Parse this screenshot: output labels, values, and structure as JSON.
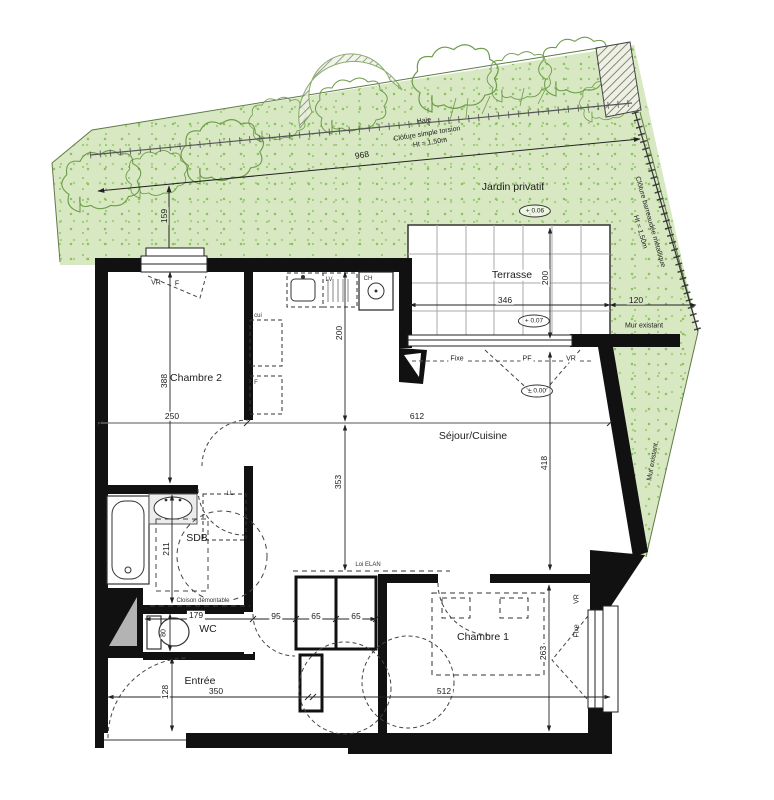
{
  "garden": {
    "label": "Jardin privatif",
    "level": "+ 0.06",
    "hedge": "Haie",
    "fence_top_type": "Clôture simple torsion",
    "fence_top_height": "Ht = 1,50m",
    "fence_right_type": "Clôture barreaudée métallique",
    "fence_right_height": "Ht = 1,50m"
  },
  "terrace": {
    "label": "Terrasse",
    "level": "+ 0.07"
  },
  "building": {
    "existing_wall_top": "Mur existant",
    "existing_wall_diagonal": "Mur existant",
    "ground_level": "± 0.00",
    "removable_partition": "Cloison démontable",
    "elan_note": "Loi ELAN"
  },
  "rooms": {
    "bedroom2": "Chambre 2",
    "living_kitchen": "Séjour/Cuisine",
    "bathroom": "SDB",
    "toilet": "WC",
    "entrance": "Entrée",
    "bedroom1": "Chambre 1"
  },
  "openings": {
    "bedroom2_shutter": "VR",
    "bedroom2_window": "F",
    "bay_fixed": "Fixe",
    "bay_door": "PF",
    "bay_shutter": "VR",
    "bedroom1_shutter": "VR",
    "bedroom1_fixed": "Fixe"
  },
  "equipment": {
    "kitchen_counter": "cui",
    "fridge": "F",
    "dishwasher": "LV",
    "water_heater": "CH",
    "washing_machine": "LL"
  },
  "dimensions": {
    "garden_width": "968",
    "garden_depth": "159",
    "terrace_depth": "200",
    "terrace_width": "346",
    "side_strip": "120",
    "bedroom2_depth": "388",
    "bedroom2_width": "250",
    "living_width": "612",
    "kitchen_depth": "200",
    "living_right_depth": "418",
    "living_left_depth": "353",
    "bathroom_depth": "211",
    "bathroom_width": "179",
    "hall_width": "95",
    "closet_a": "65",
    "closet_b": "65",
    "wc_width": "80",
    "entrance_depth": "128",
    "entrance_width": "350",
    "bedroom1_width": "512",
    "bedroom1_depth": "263"
  },
  "colors": {
    "garden_fill": "#d7e8c2",
    "garden_speckle": "#8cc063",
    "tree_outline": "#6d9b4a",
    "wall": "#111111",
    "line": "#333333"
  }
}
